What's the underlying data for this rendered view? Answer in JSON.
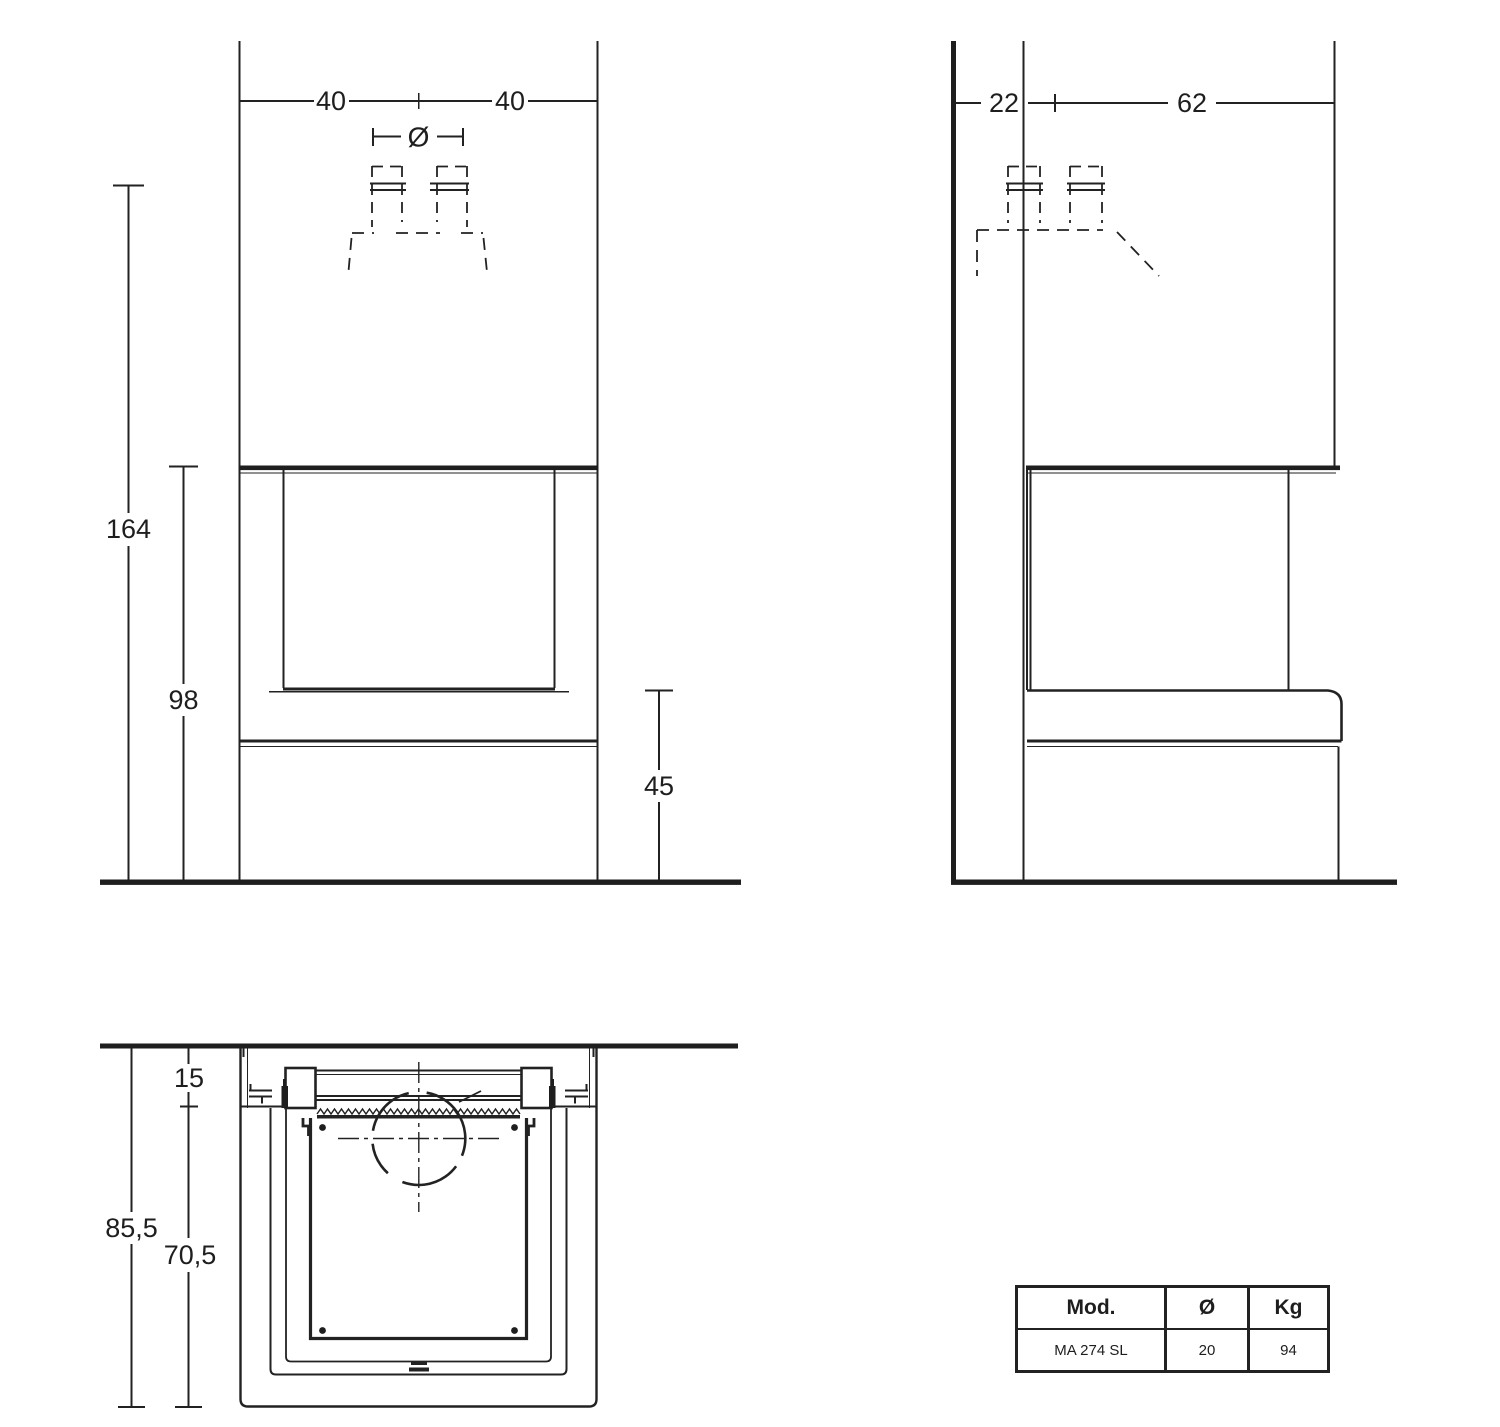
{
  "front_view": {
    "width_left": "40",
    "width_right": "40",
    "flue_diameter_symbol": "Ø",
    "total_height": "164",
    "opening_height": "98",
    "bench_height": "45"
  },
  "side_view": {
    "rear_depth": "22",
    "front_depth": "62"
  },
  "plan_view": {
    "front_inset": "15",
    "total_depth": "85,5",
    "body_depth": "70,5"
  },
  "spec_table": {
    "header_model": "Mod.",
    "header_diameter": "Ø",
    "header_weight": "Kg",
    "model": "MA 274 SL",
    "diameter": "20",
    "weight": "94"
  }
}
